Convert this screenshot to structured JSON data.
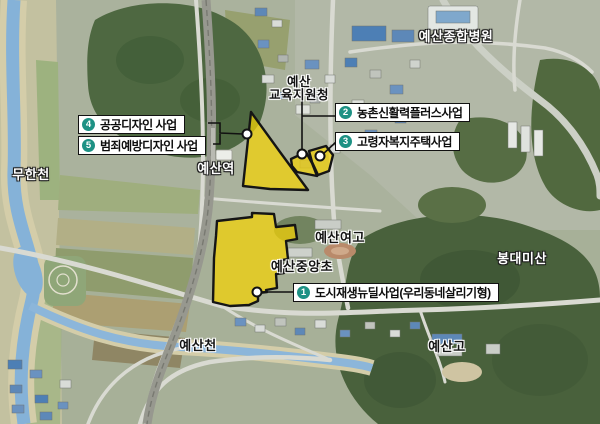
{
  "map_labels": {
    "hospital": "예산종합병원",
    "education_office_line1": "예산",
    "education_office_line2": "교육지원청",
    "muhan_stream": "무한천",
    "yesan_station": "예산역",
    "yesan_girls_high": "예산여고",
    "jungang_elementary": "예산중앙초",
    "bongdaemi_mountain": "봉대미산",
    "yesan_stream": "예산천",
    "yesan_high": "예산고"
  },
  "callouts": [
    {
      "number": "1",
      "label": "도시재생뉴딜사업(우리동네살리기형)"
    },
    {
      "number": "2",
      "label": "농촌신활력플러스사업"
    },
    {
      "number": "3",
      "label": "고령자복지주택사업"
    },
    {
      "number": "4",
      "label": "공공디자인 사업"
    },
    {
      "number": "5",
      "label": "범죄예방디자인 사업"
    }
  ],
  "colors": {
    "badge_teal": "#1d9184",
    "zone_yellow": "#f5d304",
    "zone_outline": "#151515",
    "water_blue": "#85b2d8",
    "callout_border": "#111111"
  }
}
